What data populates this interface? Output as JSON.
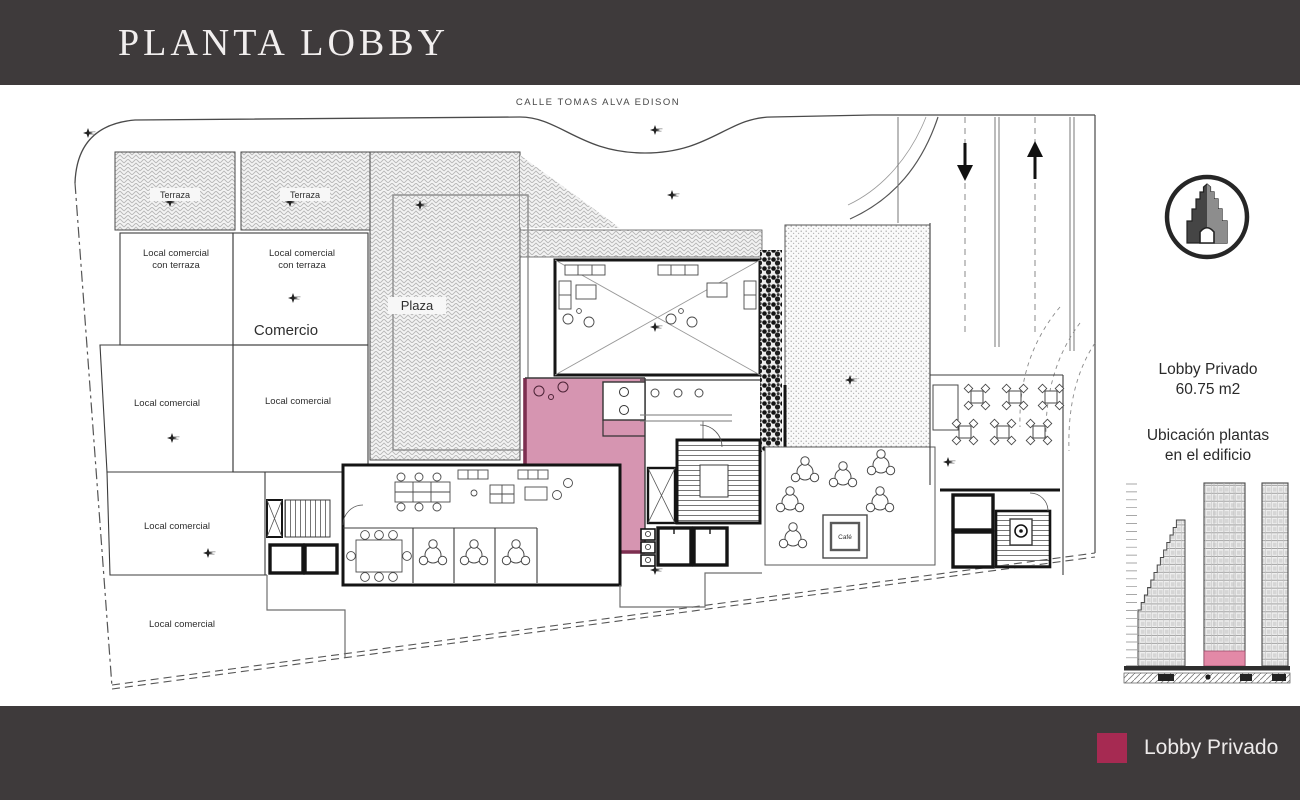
{
  "header": {
    "title": "PLANTA LOBBY"
  },
  "plan": {
    "street_label": "CALLE TOMAS ALVA EDISON",
    "terraza_left": "Terraza",
    "terraza_right": "Terraza",
    "local_terraza_1_line1": "Local comercial",
    "local_terraza_1_line2": "con terraza",
    "local_terraza_2_line1": "Local comercial",
    "local_terraza_2_line2": "con terraza",
    "comercio": "Comercio",
    "plaza": "Plaza",
    "local_a": "Local comercial",
    "local_b": "Local comercial",
    "local_c": "Local comercial",
    "local_d": "Local comercial",
    "cafe": "Café"
  },
  "sidebar": {
    "area_title": "Lobby Privado",
    "area_size": "60.75 m2",
    "location_line1": "Ubicación plantas",
    "location_line2": "en el edificio"
  },
  "footer": {
    "legend_label": "Lobby Privado",
    "legend_color": "#a62a52"
  },
  "colors": {
    "bar": "#3e3a3b",
    "lobby_fill": "#d695b1",
    "lobby_wall": "#7d2f50",
    "elevation_highlight": "#e389a7"
  }
}
